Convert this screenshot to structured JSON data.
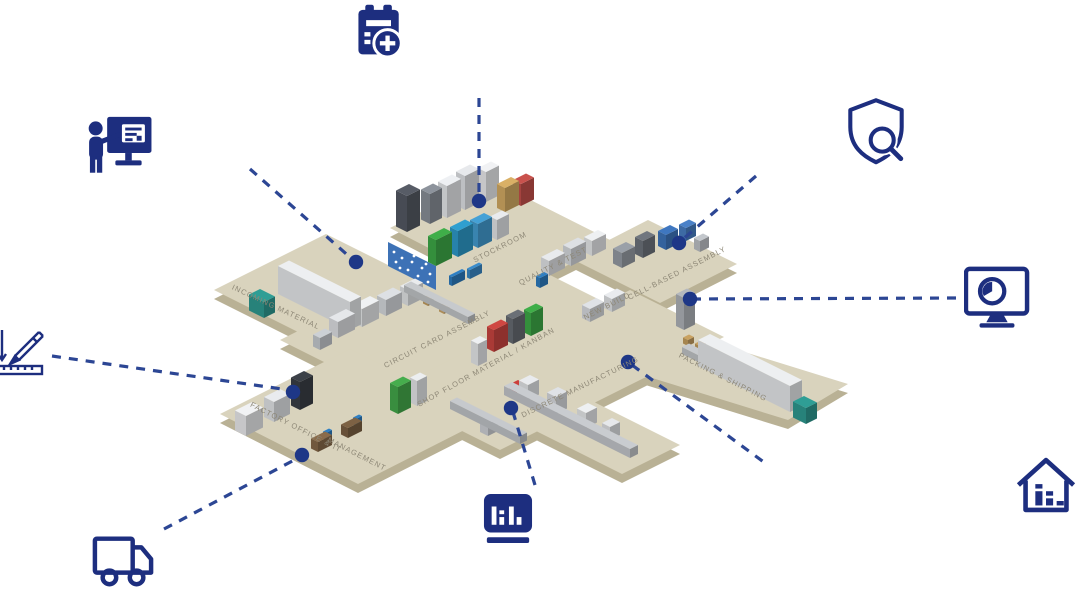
{
  "page": {
    "width": 1080,
    "height": 599,
    "background": "#ffffff"
  },
  "diagram": {
    "type": "isometric-factory-map",
    "colors": {
      "icon_navy": "#1d2e7f",
      "connector_blue": "#2c4694",
      "hotspot_navy": "#1e3787",
      "floor_top": "#d9d3bd",
      "floor_edge": "#b9b195",
      "zone_label": "#8d8776",
      "accent_teal": "#2f9e95",
      "accent_green": "#3fae49",
      "accent_blue": "#2e7fc4",
      "accent_red": "#cc4541"
    },
    "zones": [
      {
        "id": "stockroom",
        "label": "STOCKROOM"
      },
      {
        "id": "quality-test",
        "label": "QUALITY & TEST"
      },
      {
        "id": "cell-based-assembly",
        "label": "CELL-BASED ASSEMBLY"
      },
      {
        "id": "new-build",
        "label": "NEW BUILD"
      },
      {
        "id": "circuit-card-assembly",
        "label": "CIRCUIT CARD ASSEMBLY"
      },
      {
        "id": "shop-floor-material-kanban",
        "label": "SHOP FLOOR MATERIAL / KANBAN"
      },
      {
        "id": "discrete-manufacturing",
        "label": "DISCRETE MANUFACTURING"
      },
      {
        "id": "incoming-material",
        "label": "INCOMING MATERIAL"
      },
      {
        "id": "factory-office-it",
        "label": "FACTORY OFFICE & IT"
      },
      {
        "id": "management",
        "label": "MANAGEMENT"
      },
      {
        "id": "packing-shipping",
        "label": "PACKING & SHIPPING"
      }
    ],
    "icons": [
      {
        "name": "calendar-add-icon"
      },
      {
        "name": "presenter-screen-icon"
      },
      {
        "name": "pencil-ruler-icon"
      },
      {
        "name": "delivery-truck-icon"
      },
      {
        "name": "dashboard-bar-chart-icon"
      },
      {
        "name": "shield-search-icon"
      },
      {
        "name": "monitor-clock-icon"
      },
      {
        "name": "house-analytics-icon"
      }
    ]
  }
}
